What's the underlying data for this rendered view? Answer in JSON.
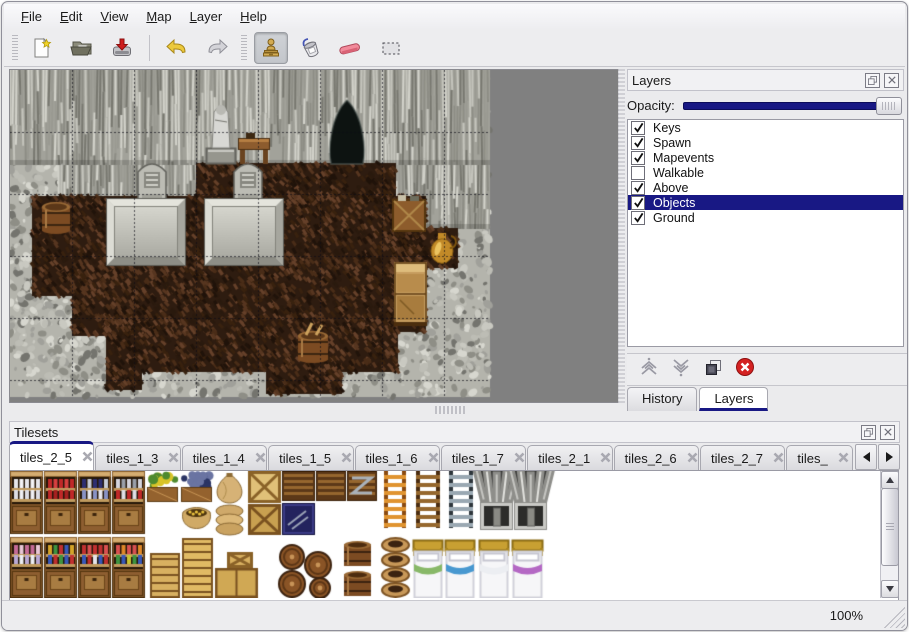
{
  "menu_bar": {
    "items": [
      {
        "label": "File"
      },
      {
        "label": "Edit"
      },
      {
        "label": "View"
      },
      {
        "label": "Map"
      },
      {
        "label": "Layer"
      },
      {
        "label": "Help"
      }
    ]
  },
  "toolbar": {
    "groups": [
      {
        "lead": "grip",
        "buttons": [
          {
            "name": "new-file-button",
            "icon": "new-file-icon"
          },
          {
            "name": "open-button",
            "icon": "open-folder-icon"
          },
          {
            "name": "save-button",
            "icon": "save-icon"
          }
        ]
      },
      {
        "lead": "sep",
        "buttons": [
          {
            "name": "undo-button",
            "icon": "undo-icon"
          },
          {
            "name": "redo-button",
            "icon": "redo-icon"
          }
        ]
      },
      {
        "lead": "grip",
        "buttons": [
          {
            "name": "stamp-tool-button",
            "icon": "stamp-icon",
            "active": true
          },
          {
            "name": "fill-tool-button",
            "icon": "fill-bucket-icon"
          },
          {
            "name": "eraser-tool-button",
            "icon": "eraser-icon"
          },
          {
            "name": "select-tool-button",
            "icon": "selection-icon"
          }
        ]
      }
    ]
  },
  "layers_panel": {
    "title": "Layers",
    "opacity_label": "Opacity:",
    "opacity_percent": 100,
    "layers": [
      {
        "name": "Keys",
        "visible": true,
        "selected": false
      },
      {
        "name": "Spawn",
        "visible": true,
        "selected": false
      },
      {
        "name": "Mapevents",
        "visible": true,
        "selected": false
      },
      {
        "name": "Walkable",
        "visible": false,
        "selected": false
      },
      {
        "name": "Above",
        "visible": true,
        "selected": false
      },
      {
        "name": "Objects",
        "visible": true,
        "selected": true
      },
      {
        "name": "Ground",
        "visible": true,
        "selected": false
      }
    ],
    "buttons": [
      {
        "name": "raise-layer-button",
        "icon": "chevrons-up-icon"
      },
      {
        "name": "lower-layer-button",
        "icon": "chevrons-down-icon"
      },
      {
        "name": "duplicate-layer-button",
        "icon": "duplicate-icon"
      },
      {
        "name": "delete-layer-button",
        "icon": "delete-icon"
      }
    ],
    "tabs": [
      {
        "label": "History",
        "active": false
      },
      {
        "label": "Layers",
        "active": true
      }
    ]
  },
  "tilesets_panel": {
    "title": "Tilesets",
    "tabs": [
      {
        "label": "tiles_2_5",
        "active": true
      },
      {
        "label": "tiles_1_3",
        "active": false
      },
      {
        "label": "tiles_1_4",
        "active": false
      },
      {
        "label": "tiles_1_5",
        "active": false
      },
      {
        "label": "tiles_1_6",
        "active": false
      },
      {
        "label": "tiles_1_7",
        "active": false
      },
      {
        "label": "tiles_2_1",
        "active": false
      },
      {
        "label": "tiles_2_6",
        "active": false
      },
      {
        "label": "tiles_2_7",
        "active": false
      },
      {
        "label": "tiles_",
        "active": false,
        "truncated": true
      }
    ]
  },
  "status_bar": {
    "zoom_level": "100%"
  },
  "colors": {
    "accent": "#181884",
    "map_bg": "#808080",
    "rock_base": "#b4b4ac",
    "wall_base": "#a2a29a",
    "floor_base": "#2e1c10"
  },
  "map_canvas": {
    "width": 480,
    "height": 327,
    "grid": 62,
    "walls": [
      [
        0,
        0,
        480,
        95
      ],
      [
        48,
        95,
        140,
        70
      ],
      [
        344,
        95,
        72,
        62
      ],
      [
        414,
        95,
        66,
        64
      ]
    ],
    "floor_rects": [
      [
        186,
        93,
        200,
        40
      ],
      [
        96,
        126,
        320,
        72
      ],
      [
        414,
        158,
        34,
        40
      ],
      [
        22,
        126,
        76,
        100
      ],
      [
        62,
        196,
        70,
        70
      ],
      [
        96,
        196,
        290,
        66
      ],
      [
        128,
        258,
        260,
        44
      ],
      [
        256,
        296,
        76,
        28
      ],
      [
        96,
        258,
        36,
        62
      ],
      [
        380,
        126,
        36,
        136
      ]
    ],
    "objects": [
      {
        "type": "cave",
        "x": 318,
        "y": 30,
        "w": 38,
        "h": 64
      },
      {
        "type": "statue",
        "x": 196,
        "y": 28,
        "w": 30,
        "h": 66
      },
      {
        "type": "table",
        "x": 228,
        "y": 62,
        "w": 32,
        "h": 32
      },
      {
        "type": "tombstone",
        "x": 128,
        "y": 92,
        "w": 28,
        "h": 37
      },
      {
        "type": "tombstone",
        "x": 224,
        "y": 92,
        "w": 28,
        "h": 37
      },
      {
        "type": "tomb",
        "x": 96,
        "y": 128,
        "w": 80,
        "h": 68
      },
      {
        "type": "tomb",
        "x": 194,
        "y": 128,
        "w": 80,
        "h": 68
      },
      {
        "type": "barrel",
        "x": 30,
        "y": 128,
        "w": 32,
        "h": 35
      },
      {
        "type": "crates",
        "x": 382,
        "y": 125,
        "w": 34,
        "h": 37
      },
      {
        "type": "jug",
        "x": 418,
        "y": 160,
        "w": 28,
        "h": 34
      },
      {
        "type": "cabinet",
        "x": 384,
        "y": 192,
        "w": 33,
        "h": 64
      },
      {
        "type": "toolbarrel",
        "x": 286,
        "y": 257,
        "w": 34,
        "h": 35
      }
    ]
  },
  "tileset_canvas": {
    "width": 853,
    "height": 127,
    "items": [
      {
        "t": "shelf",
        "x": 0,
        "y": 0,
        "w": 33,
        "h": 63,
        "r1": [
          "#e6e6ea",
          "#f4f4f6"
        ],
        "r2": [
          "#dcdce4",
          "#f0f0f4"
        ]
      },
      {
        "t": "shelf",
        "x": 34,
        "y": 0,
        "w": 33,
        "h": 63,
        "r1": [
          "#c02828",
          "#d84040"
        ],
        "r2": [
          "#c02828",
          "#a82020"
        ]
      },
      {
        "t": "shelf",
        "x": 68,
        "y": 0,
        "w": 33,
        "h": 63,
        "r1": [
          "#2e2e72",
          "#c8ccd8",
          "#2e2e72"
        ],
        "r2": [
          "#8892c4",
          "#e8e8ee"
        ]
      },
      {
        "t": "shelf",
        "x": 102,
        "y": 0,
        "w": 33,
        "h": 63,
        "r1": [
          "#d4d4dc",
          "#9aa0aa"
        ],
        "r2": [
          "#c02828",
          "#e0e0e6"
        ]
      },
      {
        "t": "plantbox",
        "x": 136,
        "y": 0,
        "w": 33,
        "h": 32,
        "c1": "#d8c428",
        "c2": "#4e8a2e"
      },
      {
        "t": "plantbox",
        "x": 170,
        "y": 0,
        "w": 33,
        "h": 32,
        "c1": "#6a74a2",
        "c2": "#2a3464"
      },
      {
        "t": "sack",
        "x": 205,
        "y": 1,
        "w": 29,
        "h": 31
      },
      {
        "t": "opensack",
        "x": 170,
        "y": 33,
        "w": 33,
        "h": 30
      },
      {
        "t": "sackpile",
        "x": 205,
        "y": 33,
        "w": 29,
        "h": 30
      },
      {
        "t": "crate",
        "x": 238,
        "y": 0,
        "w": 33,
        "h": 32,
        "c1": "#e0c078",
        "c2": "#8a6228"
      },
      {
        "t": "crate",
        "x": 238,
        "y": 33,
        "w": 33,
        "h": 31,
        "c1": "#c8a050",
        "c2": "#7a5220"
      },
      {
        "t": "slat",
        "x": 272,
        "y": 0,
        "w": 33,
        "h": 30,
        "z": false
      },
      {
        "t": "cratenavy",
        "x": 272,
        "y": 32,
        "w": 33,
        "h": 32
      },
      {
        "t": "slat",
        "x": 306,
        "y": 0,
        "w": 30,
        "h": 30,
        "z": false
      },
      {
        "t": "slat",
        "x": 337,
        "y": 0,
        "w": 30,
        "h": 30,
        "z": true
      },
      {
        "t": "ladder",
        "x": 372,
        "y": 0,
        "w": 26,
        "h": 57,
        "c1": "#8a4a10",
        "c2": "#e09430"
      },
      {
        "t": "ladder",
        "x": 404,
        "y": 0,
        "w": 28,
        "h": 57,
        "c1": "#4a2c10",
        "c2": "#96682e"
      },
      {
        "t": "ladder",
        "x": 437,
        "y": 0,
        "w": 28,
        "h": 57,
        "c1": "#2e363c",
        "c2": "#9aa8b2"
      },
      {
        "t": "archtop",
        "x": 470,
        "y": 0,
        "w": 33,
        "h": 30
      },
      {
        "t": "archtop",
        "x": 504,
        "y": 0,
        "w": 33,
        "h": 30
      },
      {
        "t": "archdoor",
        "x": 470,
        "y": 31,
        "w": 33,
        "h": 28
      },
      {
        "t": "archdoor",
        "x": 504,
        "y": 31,
        "w": 33,
        "h": 28
      },
      {
        "t": "shelf",
        "x": 0,
        "y": 66,
        "w": 33,
        "h": 61,
        "r1": [
          "#c46a96",
          "#e8c6d6",
          "#c46a96"
        ],
        "r2": [
          "#baa8d4",
          "#eceef4"
        ]
      },
      {
        "t": "shelf",
        "x": 34,
        "y": 66,
        "w": 33,
        "h": 61,
        "r1": [
          "#d4a428",
          "#3e9440",
          "#c03030",
          "#3858b8"
        ],
        "r2": [
          "#3858b8",
          "#c03030",
          "#3e9440"
        ]
      },
      {
        "t": "shelf",
        "x": 68,
        "y": 66,
        "w": 33,
        "h": 61,
        "r1": [
          "#c03030",
          "#d85050",
          "#c03030"
        ],
        "r2": [
          "#3858b8",
          "#c03030",
          "#e4e4ea"
        ]
      },
      {
        "t": "shelf",
        "x": 102,
        "y": 66,
        "w": 33,
        "h": 61,
        "r1": [
          "#d85050",
          "#e08828",
          "#d85050"
        ],
        "r2": [
          "#3e9440",
          "#3858b8",
          "#c8c432"
        ]
      },
      {
        "t": "cratetall",
        "x": 140,
        "y": 82,
        "w": 30,
        "h": 45,
        "c1": "#d8b060"
      },
      {
        "t": "cratetall",
        "x": 172,
        "y": 67,
        "w": 31,
        "h": 60,
        "c1": "#e0ba64"
      },
      {
        "t": "crate",
        "x": 217,
        "y": 81,
        "w": 26,
        "h": 16,
        "c1": "#d8b060",
        "c2": "#8a6228"
      },
      {
        "t": "cratewide",
        "x": 205,
        "y": 97,
        "w": 43,
        "h": 30,
        "c1": "#d0a854"
      },
      {
        "t": "barrelpile",
        "x": 268,
        "y": 72,
        "w": 58,
        "h": 55
      },
      {
        "t": "barrel2",
        "x": 332,
        "y": 68,
        "w": 31,
        "h": 59
      },
      {
        "t": "potstack",
        "x": 371,
        "y": 66,
        "w": 29,
        "h": 61
      },
      {
        "t": "bed",
        "x": 403,
        "y": 69,
        "w": 30,
        "h": 58,
        "c1": "#88b868"
      },
      {
        "t": "bed",
        "x": 435,
        "y": 69,
        "w": 30,
        "h": 58,
        "c1": "#4898d0"
      },
      {
        "t": "bed",
        "x": 469,
        "y": 69,
        "w": 30,
        "h": 58,
        "c1": "#eceef2"
      },
      {
        "t": "bed",
        "x": 502,
        "y": 69,
        "w": 31,
        "h": 58,
        "c1": "#b468c4"
      }
    ]
  }
}
